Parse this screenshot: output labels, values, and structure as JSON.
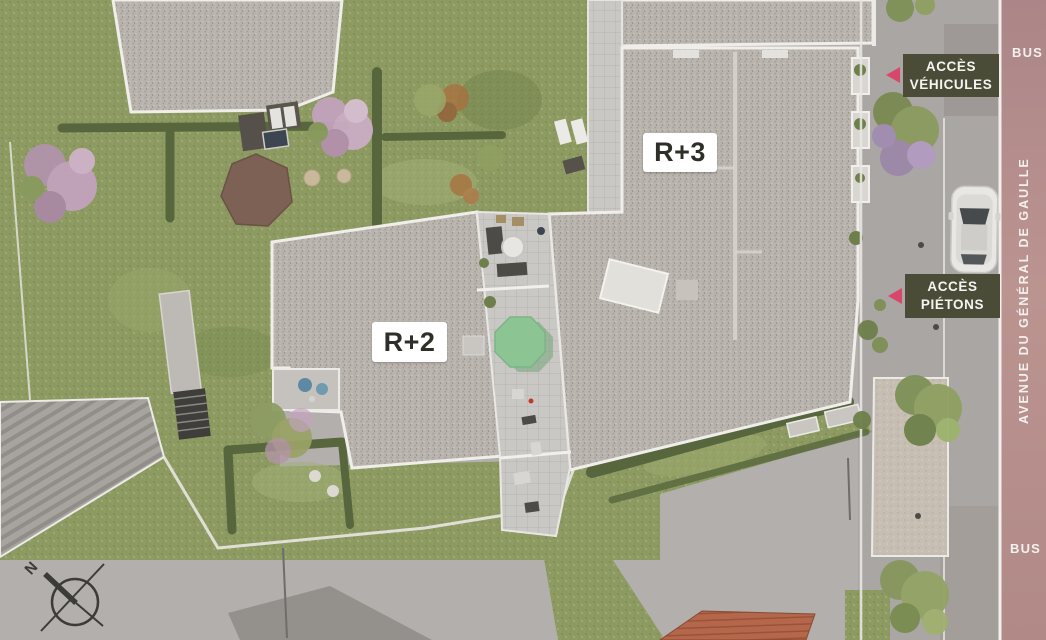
{
  "page": {
    "type": "architectural-site-plan"
  },
  "labels": {
    "building_r3": "R+3",
    "building_r2": "R+2",
    "access_vehicles": {
      "line1": "ACCÈS",
      "line2": "VÉHICULES"
    },
    "access_pedestrians": {
      "line1": "ACCÈS",
      "line2": "PIÉTONS"
    },
    "bus_top": "BUS",
    "bus_bottom": "BUS",
    "street_name": "AVENUE DU GÉNÉRAL DE GAULLE",
    "compass_north": "N"
  },
  "colors": {
    "access_badge_background": "#4a4c38",
    "access_arrow_pink": "#d8466b",
    "label_chip_background": "#ffffff",
    "label_text": "#2f2f2a",
    "parasol_green": "#8cc494",
    "sidewalk_pink": "#b7908c",
    "garden_green": "#8d9b62",
    "roof_gravel": "#b8b3ac"
  }
}
